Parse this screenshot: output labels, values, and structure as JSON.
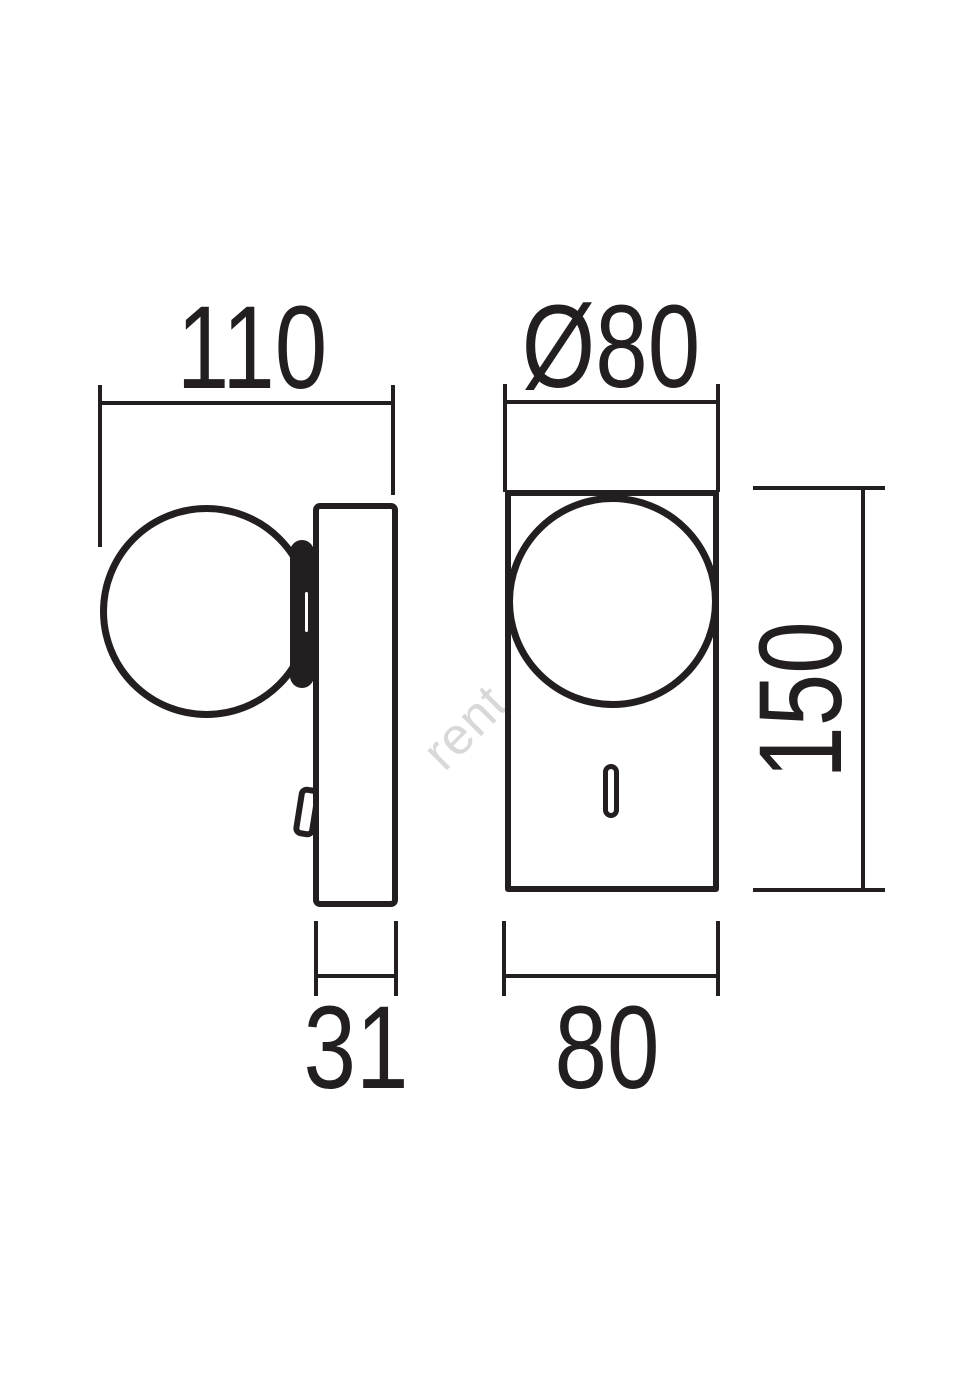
{
  "drawing": {
    "watermark": "rent.cz",
    "colors": {
      "line": "#231f20",
      "watermark": "#d8d8d8"
    },
    "dimensions": {
      "side_width": "110",
      "side_depth": "31",
      "front_diameter": "Ø80",
      "front_height": "150",
      "front_width": "80"
    }
  }
}
